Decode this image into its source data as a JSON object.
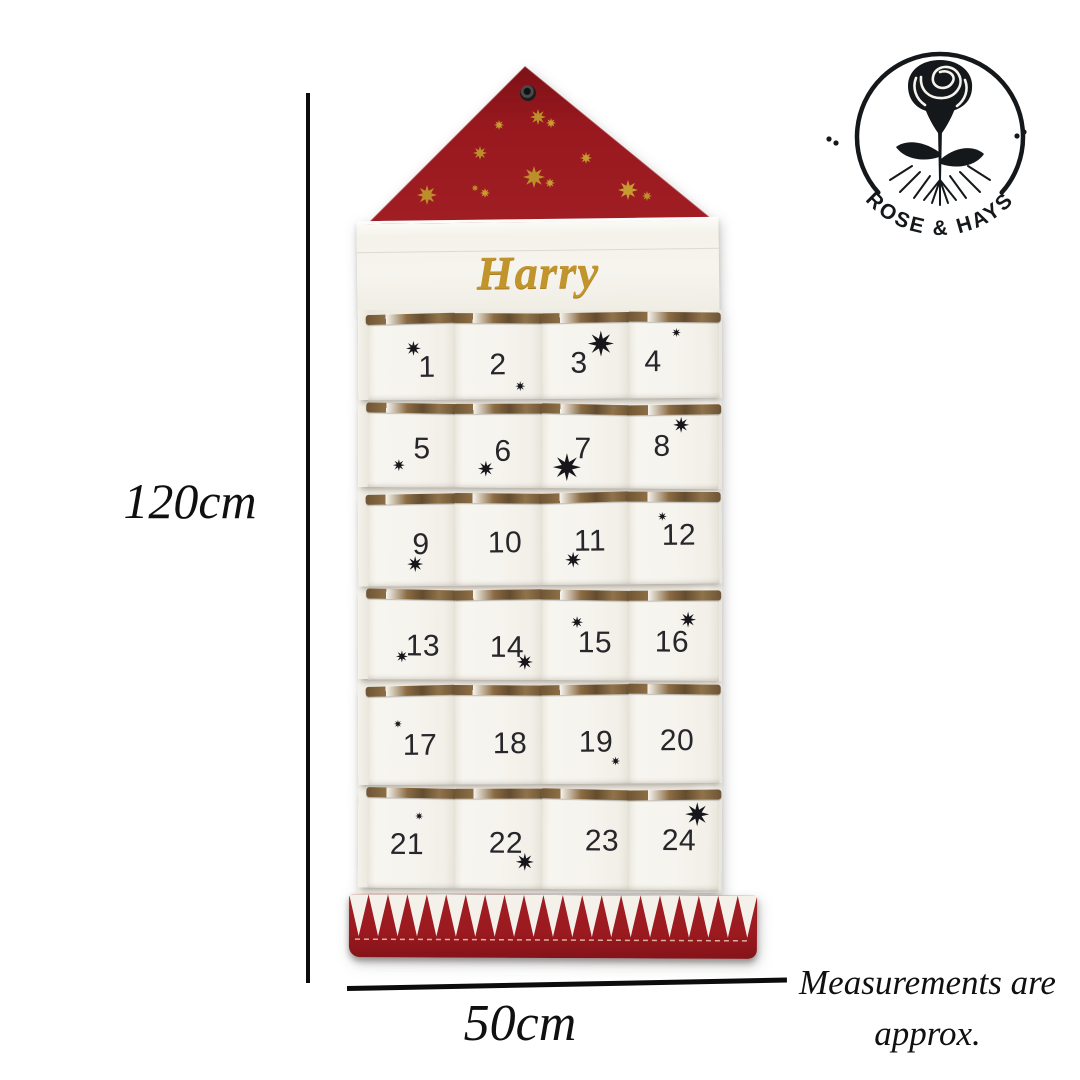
{
  "personalization": {
    "name": "Harry"
  },
  "brand": {
    "name": "ROSE & HAYS"
  },
  "dimensions": {
    "height_label": "120cm",
    "width_label": "50cm"
  },
  "disclaimer": {
    "line1": "Measurements are",
    "line2": "approx."
  },
  "colors": {
    "red": "#9d1c22",
    "red_dark": "#7c1117",
    "gold": "#c49730",
    "trim_brown": "#7e6140",
    "fabric_white": "#f6f4ee",
    "ink": "#15181a",
    "number_ink": "#26262b"
  },
  "calendar": {
    "pocket_count": 24,
    "sawtooth_teeth": 21,
    "triangle_stars": [
      [
        136,
        63,
        10
      ],
      [
        175,
        55,
        16
      ],
      [
        188,
        61,
        10
      ],
      [
        117,
        91,
        14
      ],
      [
        223,
        96,
        12
      ],
      [
        171,
        115,
        22
      ],
      [
        187,
        121,
        10
      ],
      [
        112,
        126,
        7
      ],
      [
        122,
        131,
        10
      ],
      [
        64,
        133,
        20
      ],
      [
        265,
        128,
        20
      ],
      [
        284,
        134,
        10
      ]
    ],
    "pockets": [
      {
        "number": "1",
        "number_pos": [
          59,
          54
        ],
        "star": [
          45,
          34,
          15
        ]
      },
      {
        "number": "2",
        "number_pos": [
          43,
          52
        ],
        "star": [
          65,
          73,
          10
        ]
      },
      {
        "number": "3",
        "number_pos": [
          37,
          51
        ],
        "star": [
          59,
          31,
          26
        ]
      },
      {
        "number": "4",
        "number_pos": [
          24,
          50
        ],
        "star": [
          47,
          20,
          9
        ]
      },
      {
        "number": "5",
        "number_pos": [
          54,
          46
        ],
        "star": [
          31,
          62,
          12
        ]
      },
      {
        "number": "6",
        "number_pos": [
          48,
          48
        ],
        "star": [
          31,
          65,
          16
        ]
      },
      {
        "number": "7",
        "number_pos": [
          41,
          45
        ],
        "star": [
          25,
          63,
          28
        ]
      },
      {
        "number": "8",
        "number_pos": [
          33,
          42
        ],
        "star": [
          52,
          20,
          16
        ]
      },
      {
        "number": "9",
        "number_pos": [
          53,
          51
        ],
        "star": [
          47,
          70,
          16
        ]
      },
      {
        "number": "10",
        "number_pos": [
          50,
          50
        ],
        "star": null
      },
      {
        "number": "11",
        "number_pos": [
          48,
          49
        ],
        "star": [
          31,
          67,
          16
        ]
      },
      {
        "number": "12",
        "number_pos": [
          50,
          44
        ],
        "star": [
          33,
          24,
          9
        ]
      },
      {
        "number": "13",
        "number_pos": [
          55,
          57
        ],
        "star": [
          34,
          67,
          12
        ]
      },
      {
        "number": "14",
        "number_pos": [
          52,
          58
        ],
        "star": [
          70,
          72,
          16
        ]
      },
      {
        "number": "15",
        "number_pos": [
          53,
          53
        ],
        "star": [
          35,
          32,
          12
        ]
      },
      {
        "number": "16",
        "number_pos": [
          43,
          52
        ],
        "star": [
          59,
          29,
          16
        ]
      },
      {
        "number": "17",
        "number_pos": [
          52,
          60
        ],
        "star": [
          30,
          38,
          8
        ]
      },
      {
        "number": "18",
        "number_pos": [
          55,
          59
        ],
        "star": null
      },
      {
        "number": "19",
        "number_pos": [
          54,
          58
        ],
        "star": [
          73,
          76,
          9
        ]
      },
      {
        "number": "20",
        "number_pos": [
          48,
          57
        ],
        "star": null
      },
      {
        "number": "21",
        "number_pos": [
          39,
          57
        ],
        "star": [
          51,
          28,
          8
        ]
      },
      {
        "number": "22",
        "number_pos": [
          51,
          55
        ],
        "star": [
          70,
          73,
          18
        ]
      },
      {
        "number": "23",
        "number_pos": [
          60,
          52
        ],
        "star": null
      },
      {
        "number": "24",
        "number_pos": [
          50,
          51
        ],
        "star": [
          68,
          24,
          24
        ]
      }
    ]
  }
}
